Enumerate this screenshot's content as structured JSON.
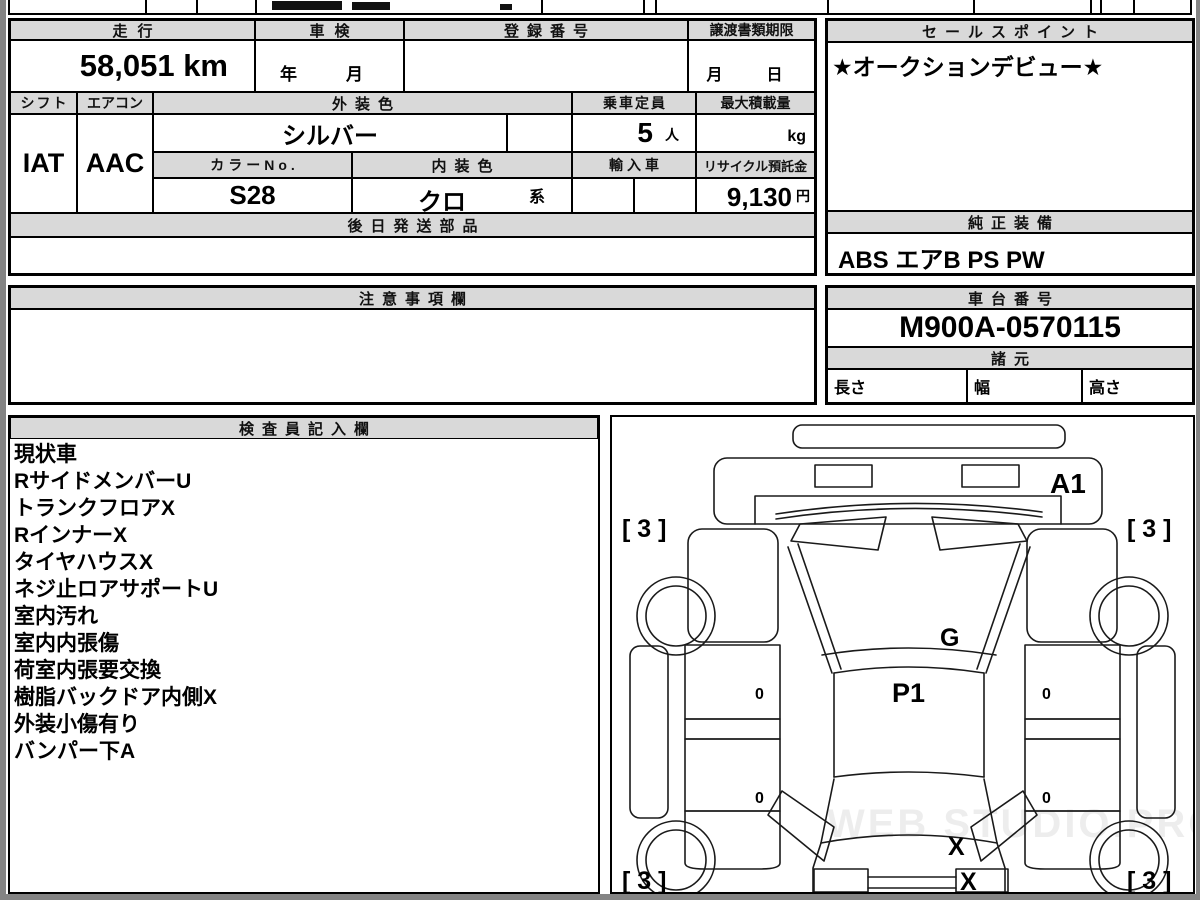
{
  "colors": {
    "paper": "#ffffff",
    "surround": "#848484",
    "header_bg": "#d9d9d9",
    "line": "#000000"
  },
  "main_table": {
    "mileage_label": "走行",
    "mileage_value": "58,051 km",
    "shaken_label": "車検",
    "shaken_value": "年　月",
    "registration_label": "登録番号",
    "registration_value": "",
    "transfer_label": "譲渡書類期限",
    "transfer_value": "月　日",
    "shift_label": "シフト",
    "shift_value": "IAT",
    "aircon_label": "エアコン",
    "aircon_value": "AAC",
    "exterior_color_label": "外装色",
    "exterior_color_value": "シルバー",
    "capacity_label": "乗車定員",
    "capacity_value": "5",
    "capacity_unit": "人",
    "max_load_label": "最大積載量",
    "max_load_unit": "kg",
    "color_no_label": "カラーNo.",
    "color_no_value": "S28",
    "interior_color_label": "内装色",
    "interior_color_value": "クロ",
    "interior_color_suffix": "系",
    "import_label": "輸入車",
    "recycle_label": "リサイクル預託金",
    "recycle_value": "9,130",
    "recycle_unit": "円",
    "later_parts_label": "後日発送部品"
  },
  "sales_point": {
    "label": "セールスポイント",
    "value": "★オークションデビュー★",
    "equipment_label": "純正装備",
    "equipment_value": "ABS エアB PS PW"
  },
  "notes": {
    "label": "注意事項欄",
    "value": ""
  },
  "chassis": {
    "label": "車台番号",
    "value": "M900A-0570115",
    "specs_label": "諸元",
    "length_label": "長さ",
    "width_label": "幅",
    "height_label": "高さ"
  },
  "inspector": {
    "label": "検査員記入欄",
    "items": [
      "現状車",
      "RサイドメンバーU",
      "トランクフロアX",
      "RインナーX",
      "タイヤハウスX",
      "ネジ止ロアサポートU",
      "室内汚れ",
      "室内内張傷",
      "荷室内張要交換",
      "樹脂バックドア内側X",
      "外装小傷有り",
      "バンパー下A"
    ]
  },
  "diagram": {
    "a1": "A1",
    "g": "G",
    "p1": "P1",
    "x_rear_window": "X",
    "x_tailgate": "X",
    "corner_tl": "[ 3 ]",
    "corner_tr": "[ 3 ]",
    "corner_bl": "[ 3 ]",
    "corner_br": "[ 3 ]",
    "handle": "0",
    "watermark": "WEB STUDIO.PRO"
  }
}
